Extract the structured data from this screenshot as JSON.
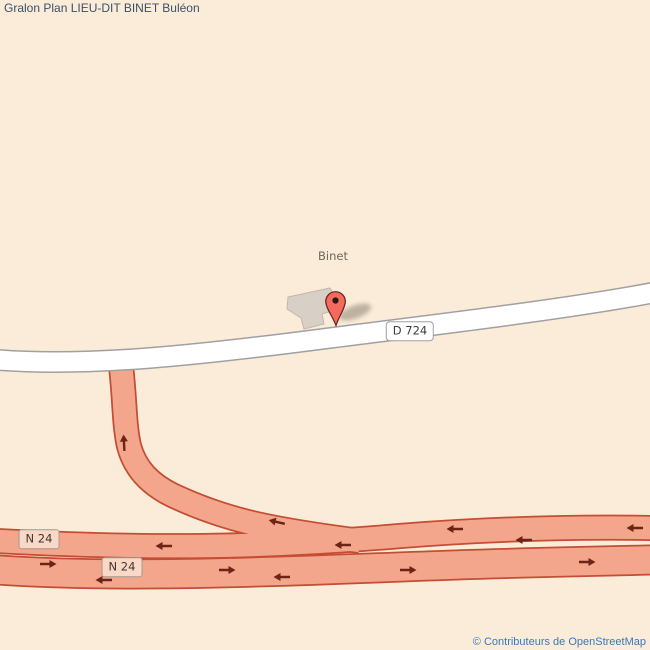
{
  "title": "Gralon Plan LIEU-DIT BINET Buléon",
  "map": {
    "place_label": "Binet",
    "shields": {
      "d724": "D 724",
      "n24_a": "N 24",
      "n24_b": "N 24"
    }
  },
  "attribution": "© Contributeurs de OpenStreetMap",
  "icons": {
    "marker": "map-pin-icon",
    "arrow": "direction-arrow-icon"
  },
  "colors": {
    "map-bg": "#FAECD9",
    "road-fill": "#F3A68B",
    "road-casing": "#C44D33",
    "arrow": "#6E2414",
    "white-road-fill": "#FFFFFF",
    "white-road-casing": "#A0A0A0",
    "building-fill": "#D8CFC6",
    "building-outline": "#C4B7AA",
    "marker-fill": "#F26B5E",
    "marker-outline": "#69201A",
    "marker-dot": "#2B1812",
    "shadow": "#5F5347",
    "shield-white-bg": "#FFFFFF",
    "shield-pink-bg": "#FAD8C8",
    "shield-border": "#A39A8F",
    "shield-text": "#3F362E",
    "d724-text": "#3C3C3C",
    "place-label": "#6E675D",
    "title-color": "#3A5068",
    "attribution-color": "#3579BE"
  }
}
